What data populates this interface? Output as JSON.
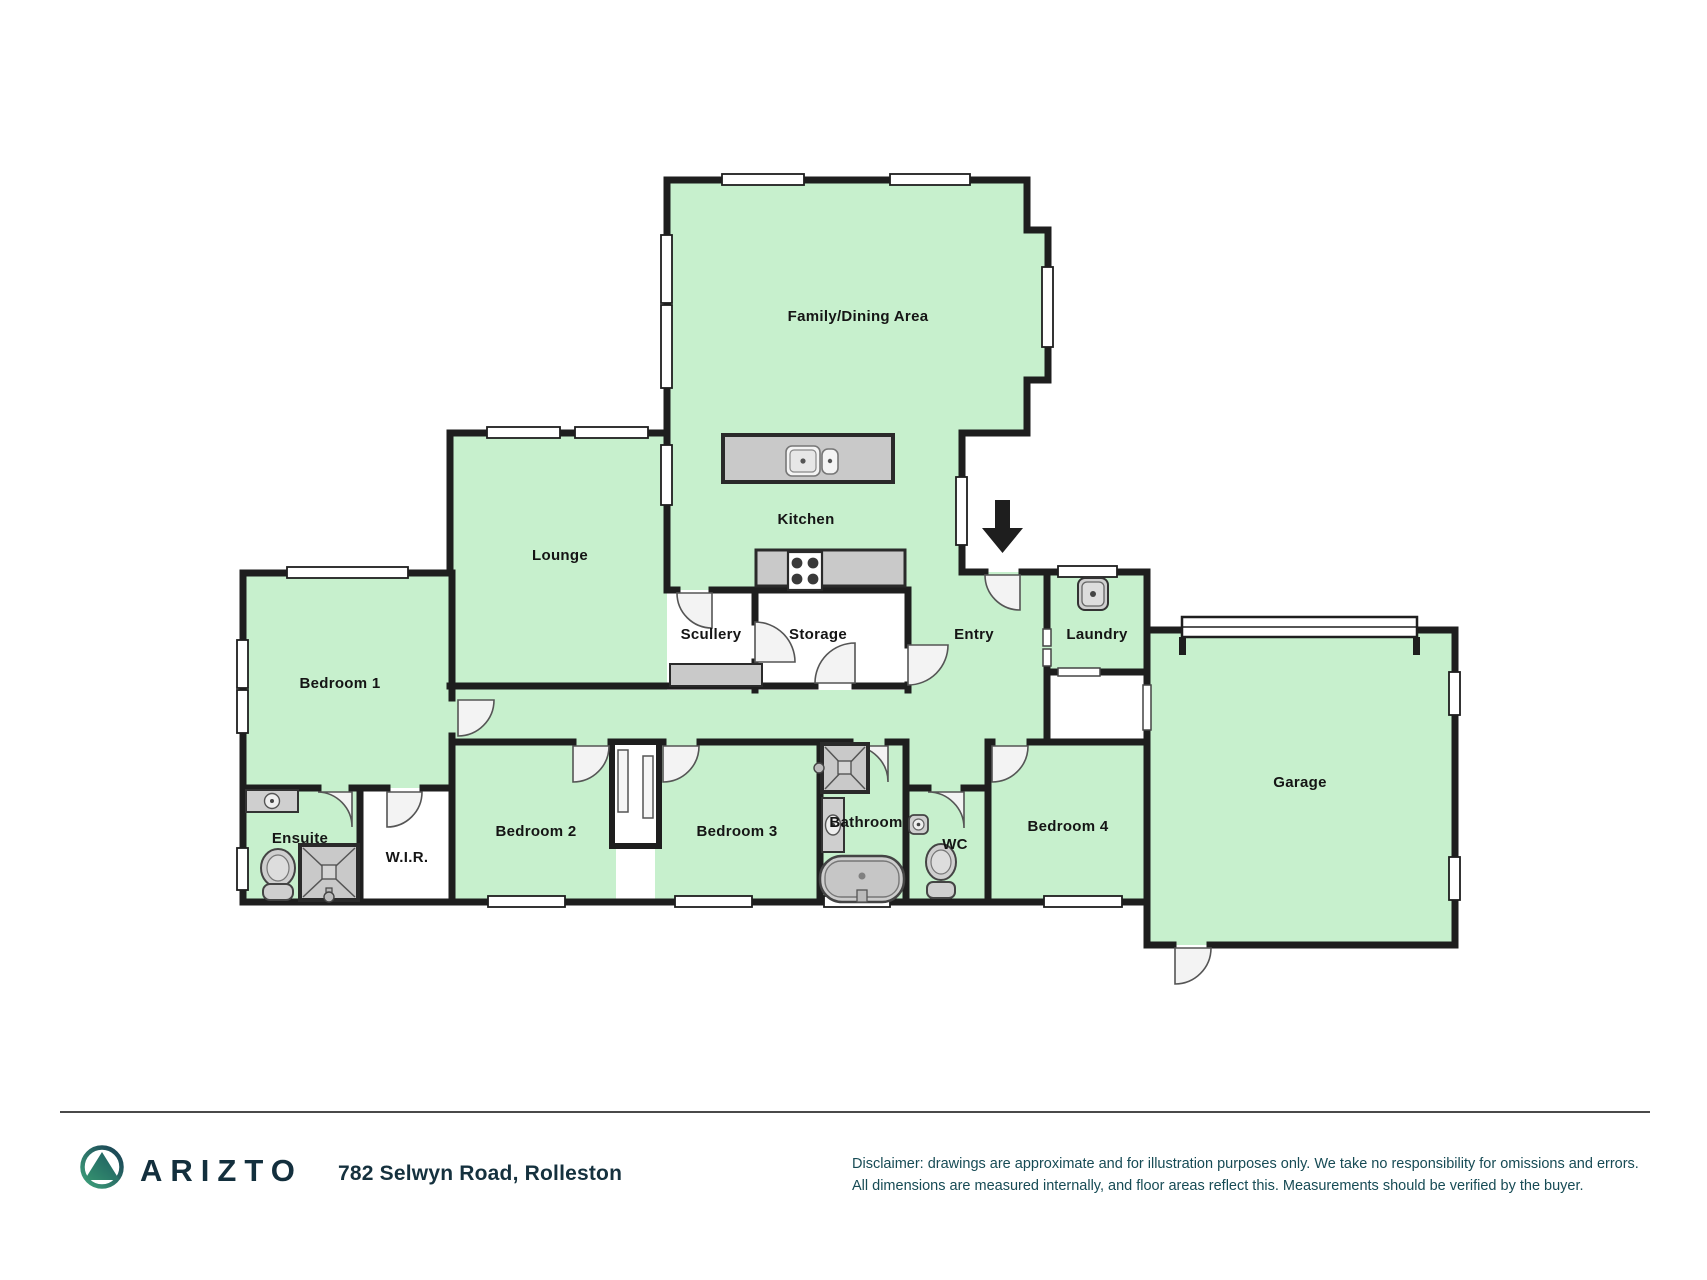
{
  "plan": {
    "rooms": [
      {
        "label": "Family/Dining Area"
      },
      {
        "label": "Kitchen"
      },
      {
        "label": "Lounge"
      },
      {
        "label": "Scullery"
      },
      {
        "label": "Storage"
      },
      {
        "label": "Entry"
      },
      {
        "label": "Laundry"
      },
      {
        "label": "Bedroom 1"
      },
      {
        "label": "Ensuite"
      },
      {
        "label": "W.I.R."
      },
      {
        "label": "Bedroom 2"
      },
      {
        "label": "Bedroom 3"
      },
      {
        "label": "Bathroom"
      },
      {
        "label": "WC"
      },
      {
        "label": "Bedroom 4"
      },
      {
        "label": "Garage"
      }
    ],
    "icons": [
      "entry-arrow-icon",
      "kitchen-island-sink-icon",
      "stove-icon",
      "shower-icon",
      "toilet-icon",
      "bathtub-icon",
      "vanity-sink-icon",
      "laundry-tub-icon"
    ],
    "colors": {
      "room_fill": "#c7f0cd",
      "wall": "#1e1e1e",
      "fixture_fill": "#cdcdcd",
      "brand_navy": "#132f3d",
      "disclaimer_teal": "#174b55",
      "logo_green": "#3fa47c",
      "logo_teal": "#173d52"
    }
  },
  "footer": {
    "brand": "ARIZTO",
    "address": "782 Selwyn Road, Rolleston",
    "disclaimer_line1": "Disclaimer: drawings are approximate and for illustration purposes only. We take no responsibility for omissions and errors.",
    "disclaimer_line2": "All dimensions are measured internally, and floor areas reflect this. Measurements should be verified by the buyer."
  }
}
